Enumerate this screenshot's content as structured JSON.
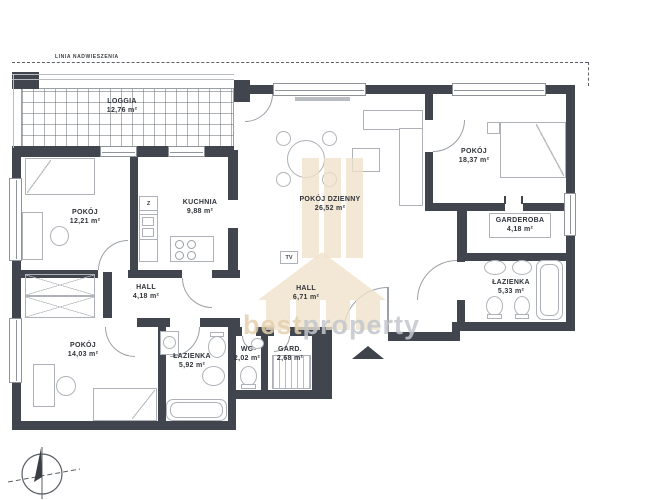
{
  "plan": {
    "overhang_label": "LINIA NADWIESZENIA",
    "watermark": {
      "part1": "best",
      "part2": "property"
    },
    "furniture_labels": {
      "tv": "TV",
      "kitchen_z": "Z"
    },
    "colors": {
      "wall": "#41464e",
      "furniture_line": "#aeb2b8",
      "watermark_beige": "#f0e1cb"
    },
    "rooms": [
      {
        "id": "loggia",
        "name": "LOGGIA",
        "area": "12,76 m²"
      },
      {
        "id": "pokoj-1",
        "name": "POKÓJ",
        "area": "12,21 m²"
      },
      {
        "id": "kuchnia",
        "name": "KUCHNIA",
        "area": "9,88 m²"
      },
      {
        "id": "pokoj-dzienny",
        "name": "POKÓJ DZIENNY",
        "area": "26,52 m²"
      },
      {
        "id": "pokoj-2",
        "name": "POKÓJ",
        "area": "18,37 m²"
      },
      {
        "id": "garderoba",
        "name": "GARDEROBA",
        "area": "4,18 m²"
      },
      {
        "id": "lazienka-1",
        "name": "ŁAZIENKA",
        "area": "5,33 m²"
      },
      {
        "id": "hall-1",
        "name": "HALL",
        "area": "4,18 m²"
      },
      {
        "id": "hall-2",
        "name": "HALL",
        "area": "6,71 m²"
      },
      {
        "id": "pokoj-3",
        "name": "POKÓJ",
        "area": "14,03 m²"
      },
      {
        "id": "lazienka-2",
        "name": "ŁAZIENKA",
        "area": "5,92 m²"
      },
      {
        "id": "wc",
        "name": "WC",
        "area": "2,02 m²"
      },
      {
        "id": "gard",
        "name": "GARD.",
        "area": "2,68 m²"
      }
    ]
  }
}
